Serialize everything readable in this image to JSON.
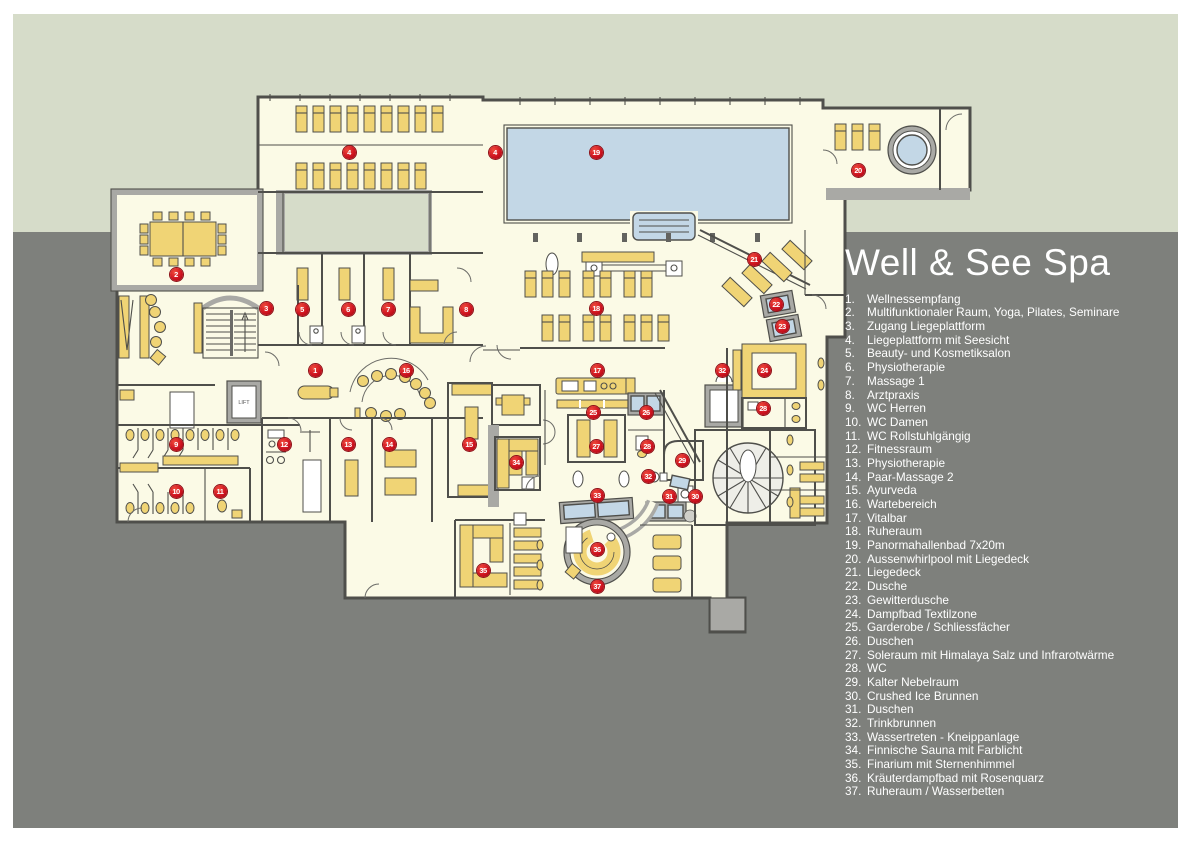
{
  "legend": {
    "title": "Well & See Spa",
    "items": [
      {
        "n": "1",
        "label": "Wellnessempfang"
      },
      {
        "n": "2",
        "label": "Multifunktionaler Raum, Yoga, Pilates, Seminare"
      },
      {
        "n": "3",
        "label": "Zugang Liegeplattform"
      },
      {
        "n": "4",
        "label": "Liegeplattform mit Seesicht"
      },
      {
        "n": "5",
        "label": "Beauty- und Kosmetiksalon"
      },
      {
        "n": "6",
        "label": "Physiotherapie"
      },
      {
        "n": "7",
        "label": "Massage 1"
      },
      {
        "n": "8",
        "label": "Arztpraxis"
      },
      {
        "n": "9",
        "label": "WC Herren"
      },
      {
        "n": "10",
        "label": "WC Damen"
      },
      {
        "n": "11",
        "label": "WC Rollstuhlgängig"
      },
      {
        "n": "12",
        "label": "Fitnessraum"
      },
      {
        "n": "13",
        "label": "Physiotherapie"
      },
      {
        "n": "14",
        "label": "Paar-Massage 2"
      },
      {
        "n": "15",
        "label": "Ayurveda"
      },
      {
        "n": "16",
        "label": "Wartebereich"
      },
      {
        "n": "17",
        "label": "Vitalbar"
      },
      {
        "n": "18",
        "label": "Ruheraum"
      },
      {
        "n": "19",
        "label": "Panormahallenbad 7x20m"
      },
      {
        "n": "20",
        "label": "Aussenwhirlpool mit Liegedeck"
      },
      {
        "n": "21",
        "label": "Liegedeck"
      },
      {
        "n": "22",
        "label": "Dusche"
      },
      {
        "n": "23",
        "label": "Gewitterdusche"
      },
      {
        "n": "24",
        "label": "Dampfbad Textilzone"
      },
      {
        "n": "25",
        "label": "Garderobe / Schliessfächer"
      },
      {
        "n": "26",
        "label": "Duschen"
      },
      {
        "n": "27",
        "label": "Soleraum mit Himalaya Salz und Infrarotwärme"
      },
      {
        "n": "28",
        "label": "WC"
      },
      {
        "n": "29",
        "label": "Kalter Nebelraum"
      },
      {
        "n": "30",
        "label": "Crushed Ice Brunnen"
      },
      {
        "n": "31",
        "label": "Duschen"
      },
      {
        "n": "32",
        "label": "Trinkbrunnen"
      },
      {
        "n": "33",
        "label": "Wassertreten - Kneippanlage"
      },
      {
        "n": "34",
        "label": "Finnische Sauna mit Farblicht"
      },
      {
        "n": "35",
        "label": "Finarium mit Sternenhimmel"
      },
      {
        "n": "36",
        "label": "Kräuterdampfbad mit Rosenquarz"
      },
      {
        "n": "37",
        "label": "Ruheraum / Wasserbetten"
      }
    ]
  },
  "lift_label": "LIFT",
  "markers": [
    {
      "n": "1",
      "x": 315,
      "y": 370
    },
    {
      "n": "2",
      "x": 176,
      "y": 274
    },
    {
      "n": "3",
      "x": 266,
      "y": 308
    },
    {
      "n": "4",
      "x": 349,
      "y": 152
    },
    {
      "n": "4",
      "x": 495,
      "y": 152
    },
    {
      "n": "5",
      "x": 302,
      "y": 309
    },
    {
      "n": "6",
      "x": 348,
      "y": 309
    },
    {
      "n": "7",
      "x": 388,
      "y": 309
    },
    {
      "n": "8",
      "x": 466,
      "y": 309
    },
    {
      "n": "9",
      "x": 176,
      "y": 444
    },
    {
      "n": "10",
      "x": 176,
      "y": 491
    },
    {
      "n": "11",
      "x": 220,
      "y": 491
    },
    {
      "n": "12",
      "x": 284,
      "y": 444
    },
    {
      "n": "13",
      "x": 348,
      "y": 444
    },
    {
      "n": "14",
      "x": 389,
      "y": 444
    },
    {
      "n": "15",
      "x": 469,
      "y": 444
    },
    {
      "n": "16",
      "x": 406,
      "y": 370
    },
    {
      "n": "17",
      "x": 597,
      "y": 370
    },
    {
      "n": "18",
      "x": 596,
      "y": 308
    },
    {
      "n": "19",
      "x": 596,
      "y": 152
    },
    {
      "n": "20",
      "x": 858,
      "y": 170
    },
    {
      "n": "21",
      "x": 754,
      "y": 259
    },
    {
      "n": "22",
      "x": 776,
      "y": 304
    },
    {
      "n": "23",
      "x": 782,
      "y": 326
    },
    {
      "n": "24",
      "x": 764,
      "y": 370
    },
    {
      "n": "25",
      "x": 593,
      "y": 412
    },
    {
      "n": "26",
      "x": 646,
      "y": 412
    },
    {
      "n": "27",
      "x": 596,
      "y": 446
    },
    {
      "n": "28",
      "x": 647,
      "y": 446
    },
    {
      "n": "28",
      "x": 763,
      "y": 408
    },
    {
      "n": "29",
      "x": 682,
      "y": 460
    },
    {
      "n": "30",
      "x": 695,
      "y": 496
    },
    {
      "n": "31",
      "x": 669,
      "y": 496
    },
    {
      "n": "32",
      "x": 722,
      "y": 370
    },
    {
      "n": "32",
      "x": 648,
      "y": 476
    },
    {
      "n": "33",
      "x": 597,
      "y": 495
    },
    {
      "n": "34",
      "x": 516,
      "y": 462
    },
    {
      "n": "35",
      "x": 483,
      "y": 570
    },
    {
      "n": "36",
      "x": 597,
      "y": 549
    },
    {
      "n": "37",
      "x": 597,
      "y": 586
    }
  ],
  "colors": {
    "outdoor_green": "#d6dcc9",
    "ground_gray": "#7e807c",
    "floor_cream": "#fbfae6",
    "wall_gray": "#a9a9a5",
    "wall_dark": "#4f4f4b",
    "furniture_yellow": "#f0d475",
    "water_blue": "#c3d7e6",
    "marker_red": "#cc1019"
  }
}
